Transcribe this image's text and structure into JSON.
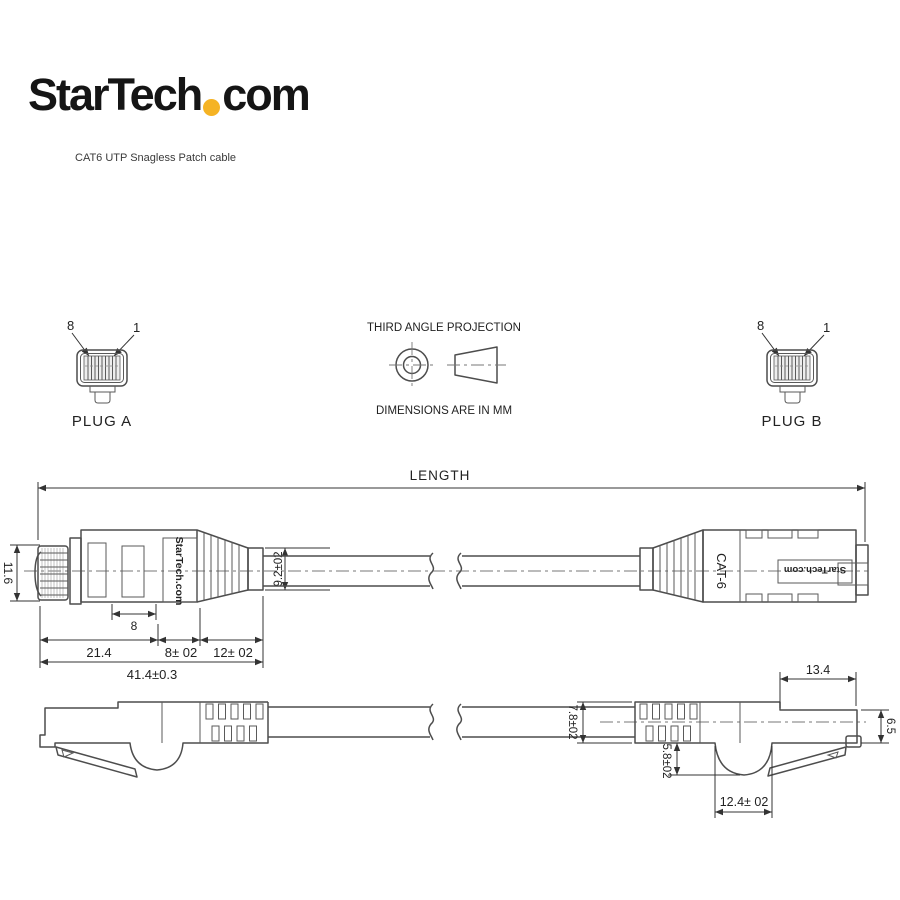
{
  "header": {
    "logo_prefix": "StarTech",
    "logo_suffix": "com",
    "logo_dot_color": "#F5B324",
    "subtitle": "CAT6 UTP Snagless Patch cable"
  },
  "projection": {
    "title": "THIRD ANGLE PROJECTION",
    "units_note": "DIMENSIONS ARE IN MM"
  },
  "plug_a": {
    "name": "PLUG A",
    "pin_left": "8",
    "pin_right": "1"
  },
  "plug_b": {
    "name": "PLUG B",
    "pin_left": "8",
    "pin_right": "1"
  },
  "drawing": {
    "length_label": "LENGTH",
    "top_view": {
      "height": "11.6",
      "inner_width": "8",
      "head_length": "21.4",
      "mid_length": "8± 02",
      "boot_length": "12± 02",
      "total_length": "41.4±0.3",
      "boot_exit_height": "9.2±02",
      "brand_text": "StarTech.com",
      "cat_label": "CAT-6",
      "brand_text_reversed": "StarTech.com"
    },
    "side_view": {
      "cable_diameter": "7.8±02",
      "hump_depth": "5.8±02",
      "hump_width": "12.4± 02",
      "tip_top_length": "13.4",
      "tip_height": "6.5"
    }
  }
}
